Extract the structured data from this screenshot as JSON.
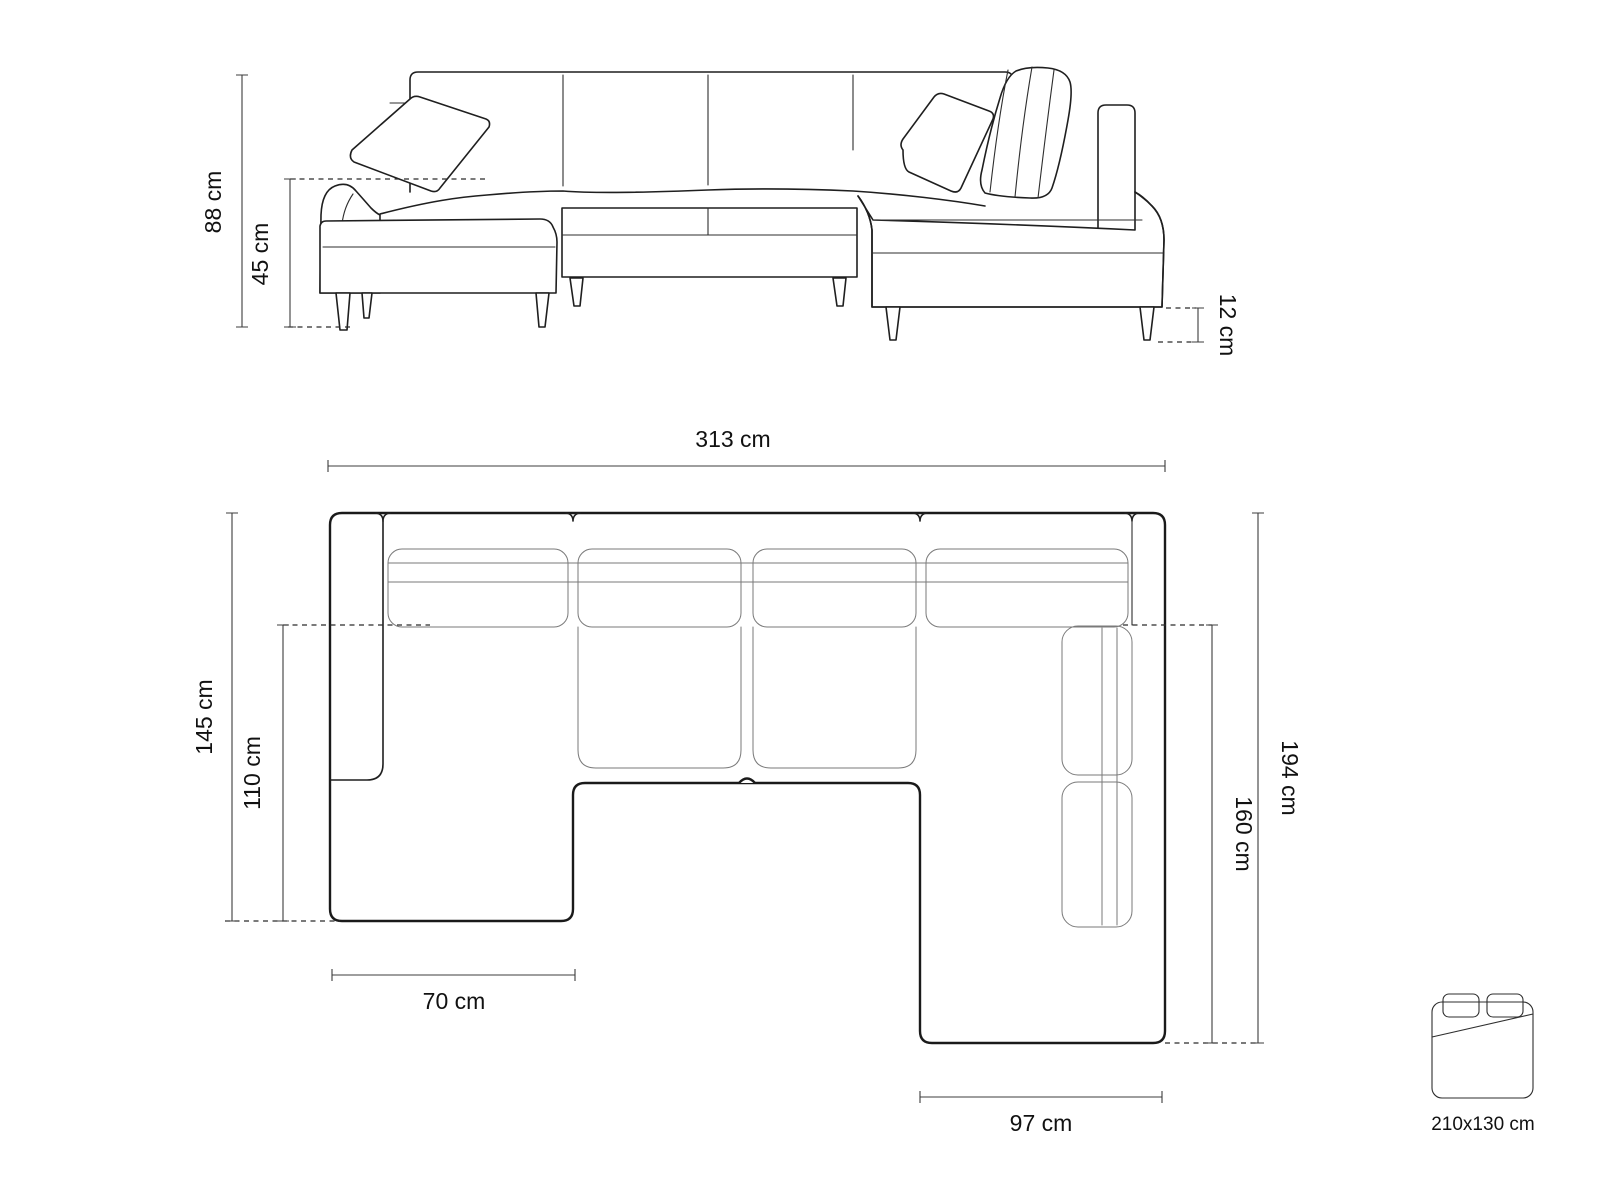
{
  "diagram": {
    "front_view": {
      "height_total": "88 cm",
      "height_seat": "45 cm",
      "height_legs": "12 cm"
    },
    "top_view": {
      "width_total": "313 cm",
      "depth_left_total": "145 cm",
      "depth_left_chaise": "110 cm",
      "depth_right_total": "194 cm",
      "depth_right_chaise": "160 cm",
      "width_left_chaise": "70 cm",
      "width_right_chaise": "97 cm"
    },
    "sleeping_area": {
      "size_label": "210x130 cm"
    },
    "colors": {
      "outline": "#1f1f1f",
      "light_line": "#7a7a7a",
      "dimension_line": "#3c3c3c",
      "background": "#ffffff"
    }
  }
}
